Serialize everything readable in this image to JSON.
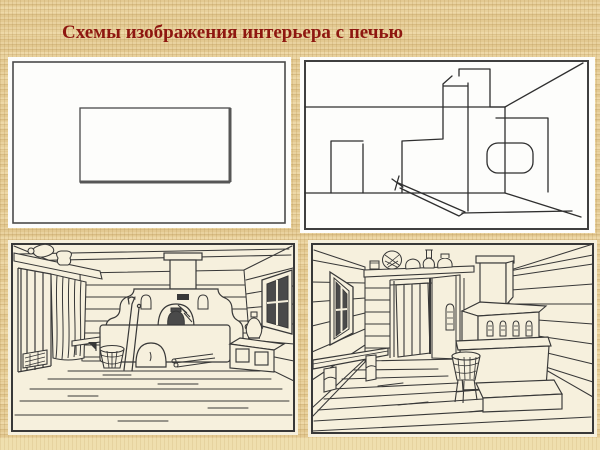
{
  "slide": {
    "title": "Схемы изображения интерьера с печью"
  },
  "colors": {
    "background_tan": "#e3c991",
    "background_light_strip": "#efdfae",
    "title_red": "#8e1710",
    "scheme_paper_white": "#fdfdfb",
    "drawing_paper_cream": "#f6f0dd",
    "ink": "#383838",
    "frame_border": "#3f3f3f"
  },
  "panels": [
    {
      "name": "scheme-frontal-perspective",
      "kind": "line-diagram",
      "description": "frontal scheme: back-wall rectangle inside room frame"
    },
    {
      "name": "scheme-angular-perspective",
      "kind": "line-diagram",
      "description": "perspective scheme of room with stepped stove, chimney, door and bench"
    },
    {
      "name": "drawing-frontal-interior",
      "kind": "ink-illustration",
      "description": "frontal view of izba interior with russian stove, door, curtain, bucket, chest with samovar, window"
    },
    {
      "name": "drawing-angular-interior",
      "kind": "ink-illustration",
      "description": "angular view of izba interior with stove, open door, crockery shelf, wall bench, window, tub"
    }
  ]
}
